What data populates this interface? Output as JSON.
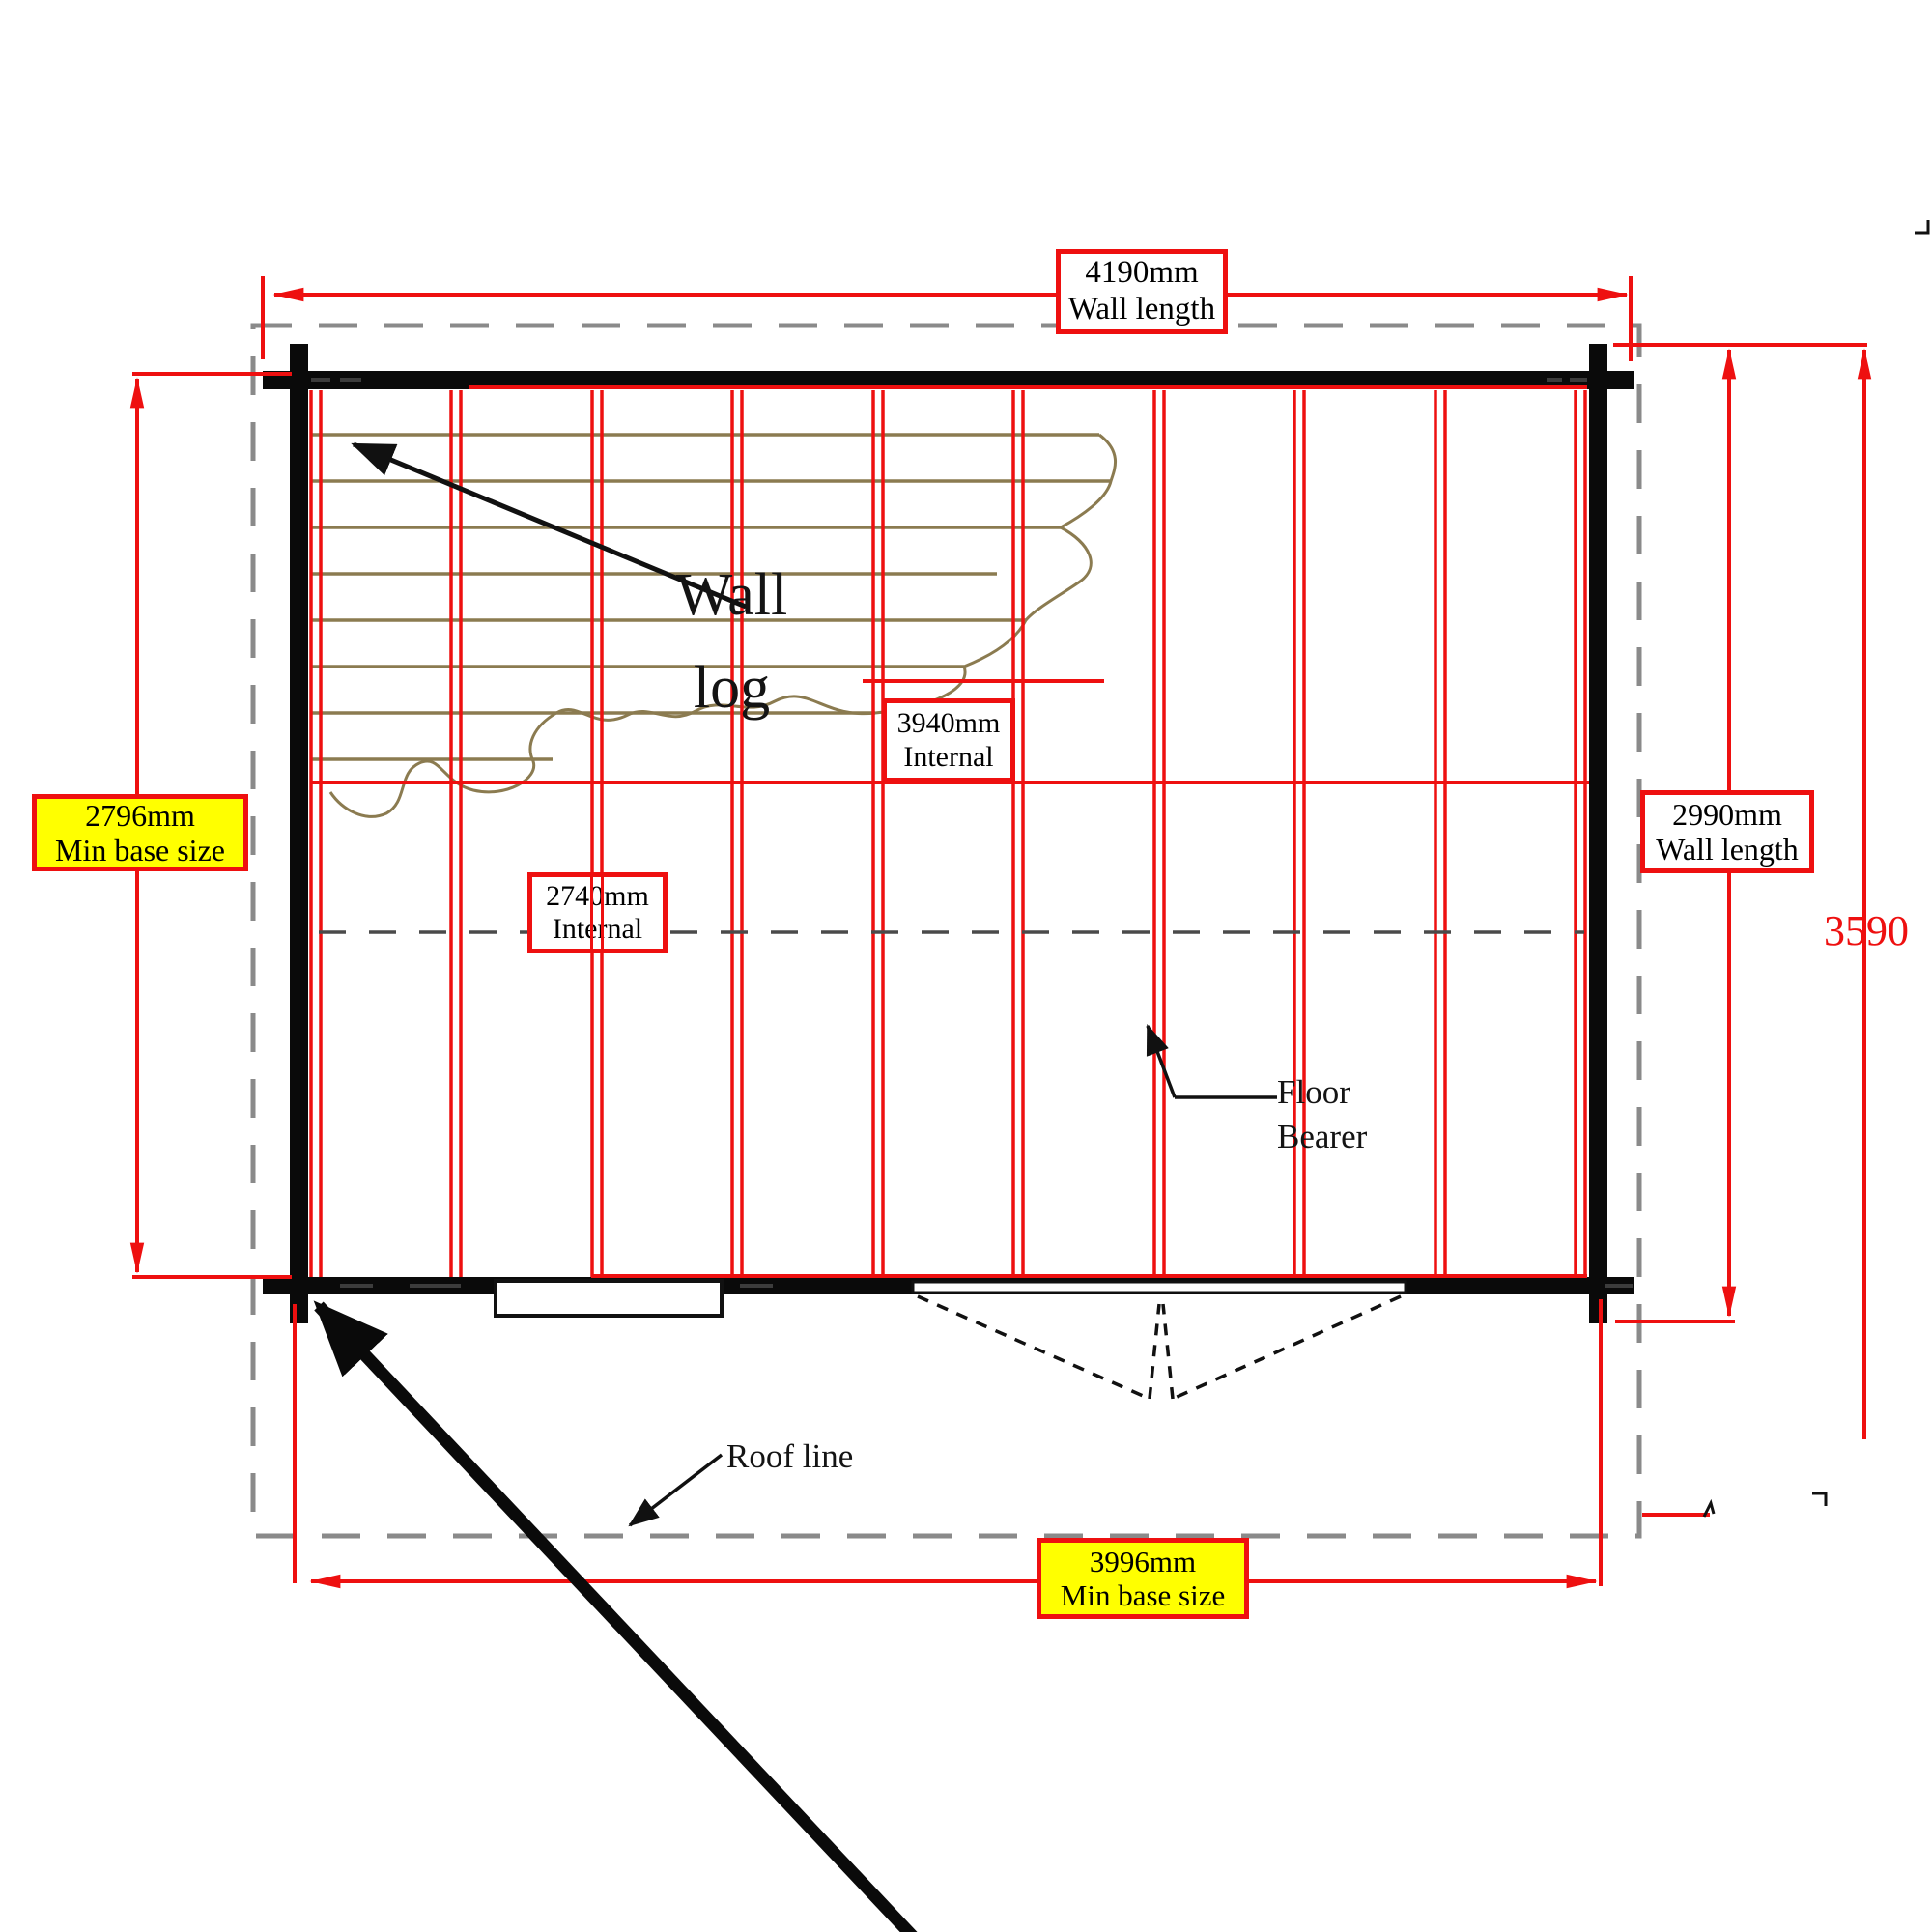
{
  "labels": {
    "wall_length_top": {
      "value": "4190mm",
      "caption": "Wall length"
    },
    "min_base_left": {
      "value": "2796mm",
      "caption": "Min base size"
    },
    "wall_length_right": {
      "value": "2990mm",
      "caption": "Wall length"
    },
    "overall_depth": {
      "value": "3590"
    },
    "internal_width": {
      "value": "3940mm",
      "caption": "Internal"
    },
    "internal_depth": {
      "value": "2740mm",
      "caption": "Internal"
    },
    "min_base_bottom": {
      "value": "3996mm",
      "caption": "Min base size"
    },
    "wall_log": {
      "line1": "Wall",
      "line2": "log"
    },
    "floor_bearer": {
      "line1": "Floor",
      "line2": "Bearer"
    },
    "roof_line": {
      "text": "Roof line"
    }
  },
  "colors": {
    "dimension_red": "#ee1010",
    "highlight_yellow": "#ffff00",
    "roof_line_gray": "#8a8a8a",
    "wood_grain_tan": "#8b7b50",
    "wall_black": "#0a0a0a"
  }
}
